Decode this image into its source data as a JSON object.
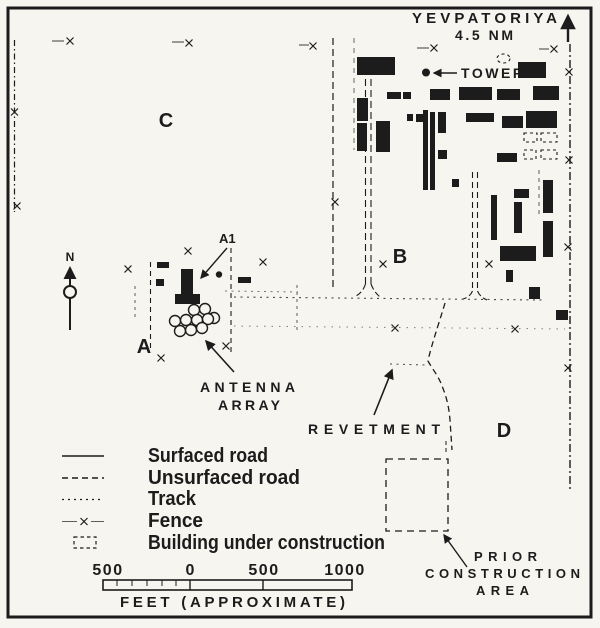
{
  "map": {
    "destination": "YEVPATORIYA",
    "distance": "4.5 NM",
    "tower": "TOWER",
    "north": "N",
    "areas": {
      "a": "A",
      "b": "B",
      "c": "C",
      "d": "D",
      "a1": "A1"
    },
    "notes": {
      "antenna1": "ANTENNA",
      "antenna2": "ARRAY",
      "revetment": "REVETMENT",
      "prior1": "PRIOR",
      "prior2": "CONSTRUCTION",
      "prior3": "AREA"
    },
    "antenna_array_circle_count": 10
  },
  "legend": {
    "items": [
      {
        "id": "surfaced-road",
        "label": "Surfaced road"
      },
      {
        "id": "unsurfaced-road",
        "label": "Unsurfaced road"
      },
      {
        "id": "track",
        "label": "Track"
      },
      {
        "id": "fence",
        "label": "Fence"
      },
      {
        "id": "building-under-construction",
        "label": "Building under construction"
      }
    ]
  },
  "scale_bar": {
    "tick_labels": [
      "500",
      "0",
      "500",
      "1000"
    ],
    "unit_label": "FEET (APPROXIMATE)"
  },
  "colors": {
    "ink": "#1c1c1c",
    "paper": "#f7f5f0"
  }
}
